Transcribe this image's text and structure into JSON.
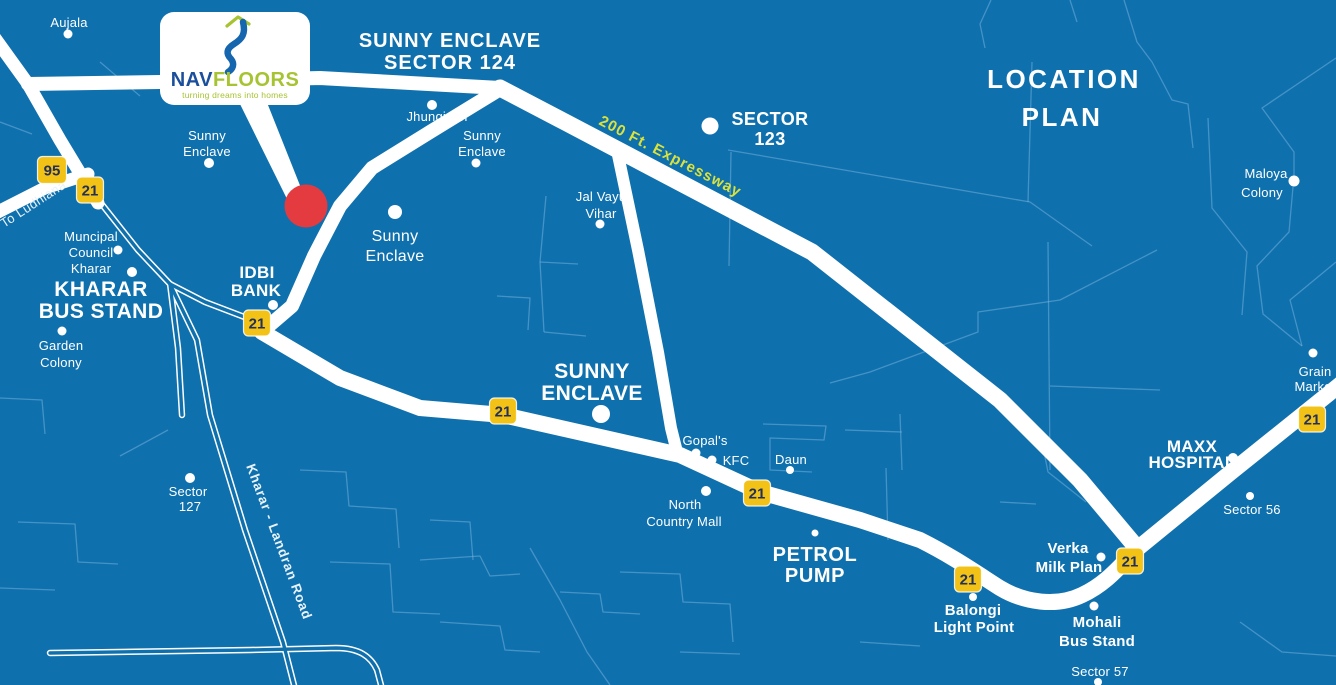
{
  "colors": {
    "background": "#0F70AE",
    "road": "#FFFFFF",
    "minor_road": "#7CB6DD",
    "shield_yellow": "#F3C217",
    "shield_text": "#22305A",
    "expressway_text": "#DCE23B",
    "marker_red": "#E33B3F",
    "logo_nav_blue": "#1B4E9B",
    "logo_squiggle_blue": "#1566AE",
    "logo_green": "#A6C332"
  },
  "title": {
    "line1": "LOCATION",
    "line2": "PLAN"
  },
  "logo": {
    "name_part1": "NAV",
    "name_part2": "FLOORS",
    "tagline": "turning dreams into homes"
  },
  "headline": {
    "line1": "SUNNY ENCLAVE",
    "line2": "SECTOR 124"
  },
  "shields": {
    "highway_95": "95",
    "highway_21": "21"
  },
  "road_labels": {
    "expressway": "200 Ft. Expressway",
    "to_ludhiana": "To Ludhiana",
    "kharar_landran": "Kharar - Landran Road"
  },
  "places": {
    "aujala": {
      "lines": [
        "Aujala"
      ]
    },
    "jhungiyan": {
      "lines": [
        "Jhungiyan"
      ]
    },
    "sunny_enclave_nw": {
      "lines": [
        "Sunny",
        "Enclave"
      ]
    },
    "sunny_enclave_n": {
      "lines": [
        "Sunny",
        "Enclave"
      ]
    },
    "sunny_enclave_mid": {
      "lines": [
        "Sunny",
        "Enclave"
      ]
    },
    "sector_123": {
      "lines": [
        "SECTOR",
        "123"
      ]
    },
    "jal_vayu_vihar": {
      "lines": [
        "Jal Vayu",
        "Vihar"
      ]
    },
    "maloya_colony": {
      "lines": [
        "Maloya",
        "Colony"
      ]
    },
    "muncipal_council_kharar": {
      "lines": [
        "Muncipal",
        "Council",
        "Kharar"
      ]
    },
    "kharar_bus_stand": {
      "lines": [
        "KHARAR",
        "BUS STAND"
      ]
    },
    "garden_colony": {
      "lines": [
        "Garden",
        "Colony"
      ]
    },
    "idbi_bank": {
      "lines": [
        "IDBI",
        "BANK"
      ]
    },
    "sunny_enclave_main": {
      "lines": [
        "SUNNY",
        "ENCLAVE"
      ]
    },
    "gopals": {
      "lines": [
        "Gopal's"
      ]
    },
    "kfc": {
      "lines": [
        "KFC"
      ]
    },
    "daun": {
      "lines": [
        "Daun"
      ]
    },
    "north_country_mall": {
      "lines": [
        "North",
        "Country Mall"
      ]
    },
    "petrol_pump": {
      "lines": [
        "PETROL",
        "PUMP"
      ]
    },
    "balongi_light_point": {
      "lines": [
        "Balongi",
        "Light Point"
      ]
    },
    "verka_milk_plan": {
      "lines": [
        "Verka",
        "Milk Plan"
      ]
    },
    "mohali_bus_stand": {
      "lines": [
        "Mohali",
        "Bus Stand"
      ]
    },
    "sector_57": {
      "lines": [
        "Sector 57"
      ]
    },
    "maxx_hospital": {
      "lines": [
        "MAXX",
        "HOSPITAL"
      ]
    },
    "sector_56": {
      "lines": [
        "Sector 56"
      ]
    },
    "grain_market": {
      "lines": [
        "Grain",
        "Market"
      ]
    },
    "sector_127": {
      "lines": [
        "Sector",
        "127"
      ]
    }
  }
}
